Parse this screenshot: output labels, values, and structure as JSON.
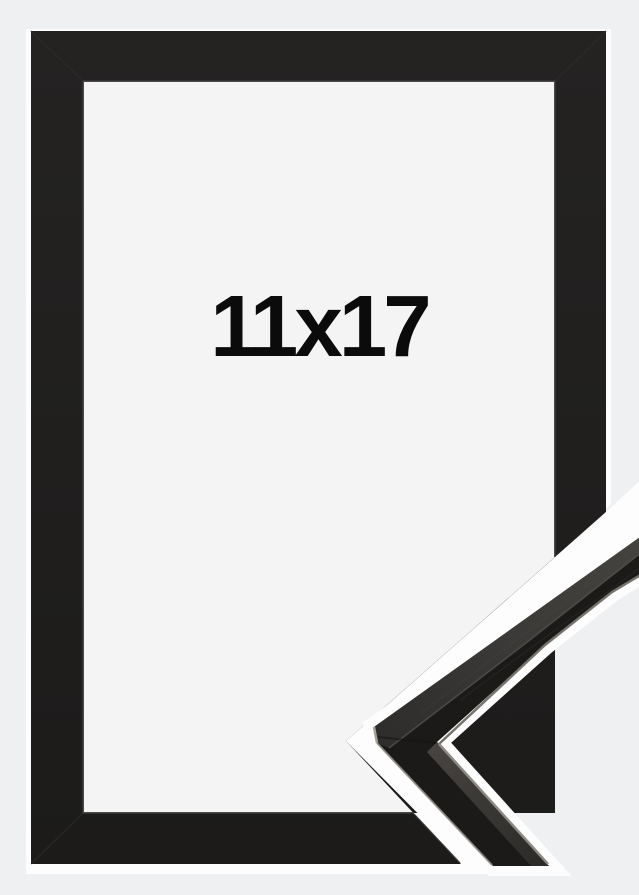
{
  "frame_photo": {
    "size_label": "11x17",
    "description": "Black picture frame, portrait orientation, with a diagonal corner cut-out revealing a close-up of the moulding profile at the lower right",
    "colors": {
      "background": "#eff0f2",
      "photo_white": "#fdfdfd",
      "inner_backdrop": "#f4f4f5",
      "frame_black": "#212020",
      "bevel": "#373634",
      "miter": "#2e2d2c",
      "moulding_dark": "#1b1a19",
      "moulding_top_face": "#3d3b39",
      "edge_highlight": "#8a8780",
      "label_text": "#0b0b0b"
    }
  }
}
